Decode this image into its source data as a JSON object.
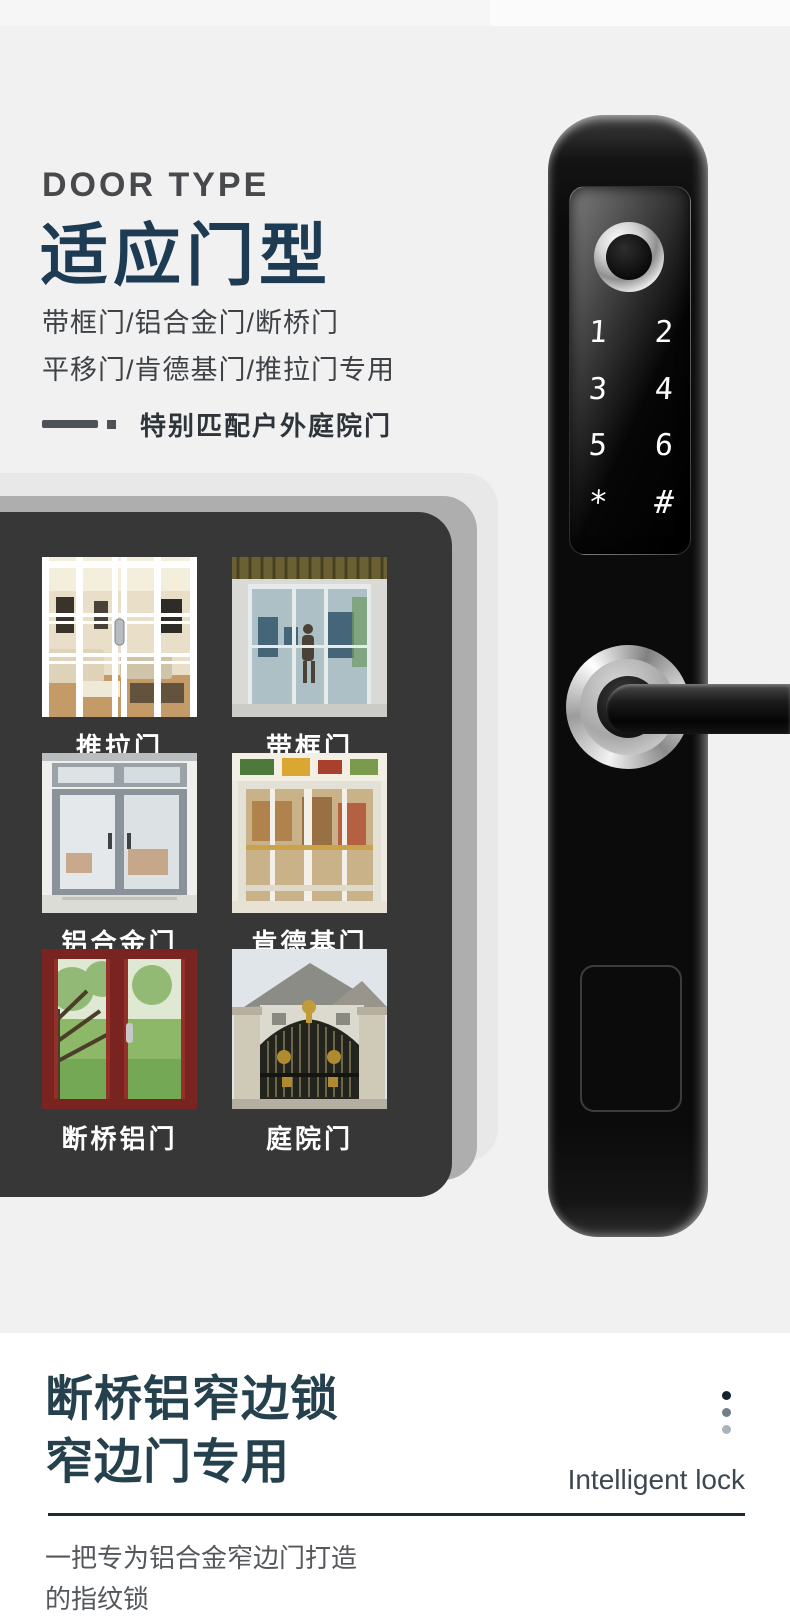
{
  "colors": {
    "page_bg": "#f1f1f1",
    "accent_navy": "#1d3b53",
    "footer_navy": "#26414e",
    "card_dark": "#373737",
    "card_mid": "#aeaeae",
    "card_light": "#e8e8e8",
    "label_white": "#ffffff",
    "dot_dark": "#12232e",
    "dot_mid": "#6e7f8a",
    "dot_light": "#a9b4ba"
  },
  "header": {
    "eyebrow": "DOOR TYPE",
    "title": "适应门型",
    "line1": "带框门/铝合金门/断桥门",
    "line2": "平移门/肯德基门/推拉门专用",
    "feature": "特别匹配户外庭院门"
  },
  "doors": {
    "items": [
      {
        "label": "推拉门"
      },
      {
        "label": "带框门"
      },
      {
        "label": "铝合金门"
      },
      {
        "label": "肯德基门"
      },
      {
        "label": "断桥铝门"
      },
      {
        "label": "庭院门"
      }
    ]
  },
  "lock": {
    "keys": [
      "1",
      "2",
      "3",
      "4",
      "5",
      "6",
      "*",
      "#"
    ]
  },
  "footer": {
    "title_line1": "断桥铝窄边锁",
    "title_line2": "窄边门专用",
    "tagline_en": "Intelligent lock",
    "desc_line1": "一把专为铝合金窄边门打造",
    "desc_line2": "的指纹锁"
  }
}
